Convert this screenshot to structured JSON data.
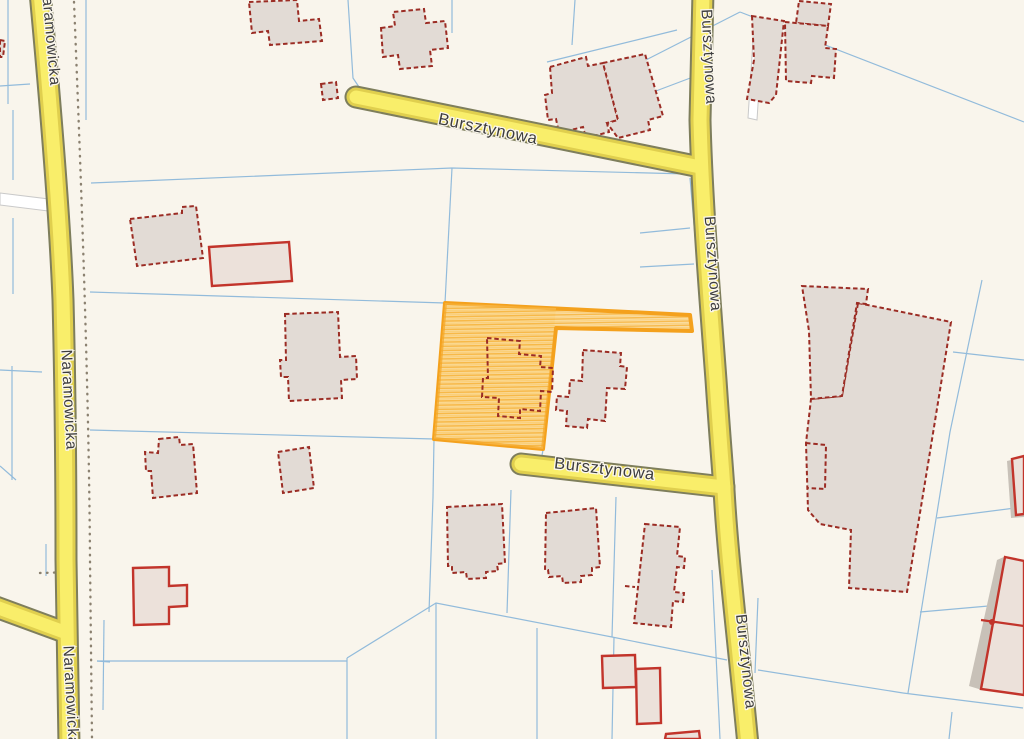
{
  "map": {
    "kind": "cadastral-parcel-map",
    "street_labels": [
      {
        "text": "Naramowicka",
        "orientation": "vertical",
        "position": "top-left",
        "clipped": true
      },
      {
        "text": "Naramowicka",
        "orientation": "vertical",
        "position": "left-middle",
        "clipped": false
      },
      {
        "text": "Naramowicka",
        "orientation": "vertical",
        "position": "bottom-left",
        "clipped": true
      },
      {
        "text": "Bursztynowa",
        "orientation": "diagonal",
        "position": "top-center",
        "clipped": false
      },
      {
        "text": "Bursztynowa",
        "orientation": "vertical",
        "position": "right-upper",
        "clipped": false
      },
      {
        "text": "Bursztynowa",
        "orientation": "vertical",
        "position": "right-middle",
        "clipped": false
      },
      {
        "text": "Bursztynowa",
        "orientation": "diagonal",
        "position": "center",
        "clipped": false
      },
      {
        "text": "Bursztynowa",
        "orientation": "vertical",
        "position": "right-lower",
        "clipped": false
      }
    ],
    "highlighted_parcel": {
      "fill_style": "orange-hatch",
      "fill": "#f9c353",
      "stroke": "#f4a11d"
    },
    "colors": {
      "background": "#f9f5ec",
      "parcel_line": "#92bbdb",
      "boundary_dots": "#8b8170",
      "road_fill": "#f9ee6a",
      "road_edge": "#e0cf4e",
      "road_casing": "#7e7e5c",
      "white_road": "#ffffff",
      "building_fill": "#e2dbd5",
      "building_outline_dashed": "#9b2c24",
      "building_outline_solid": "#c2342b",
      "building_shadow": "#c8c1b8",
      "label_text": "#3d3d3d"
    }
  }
}
